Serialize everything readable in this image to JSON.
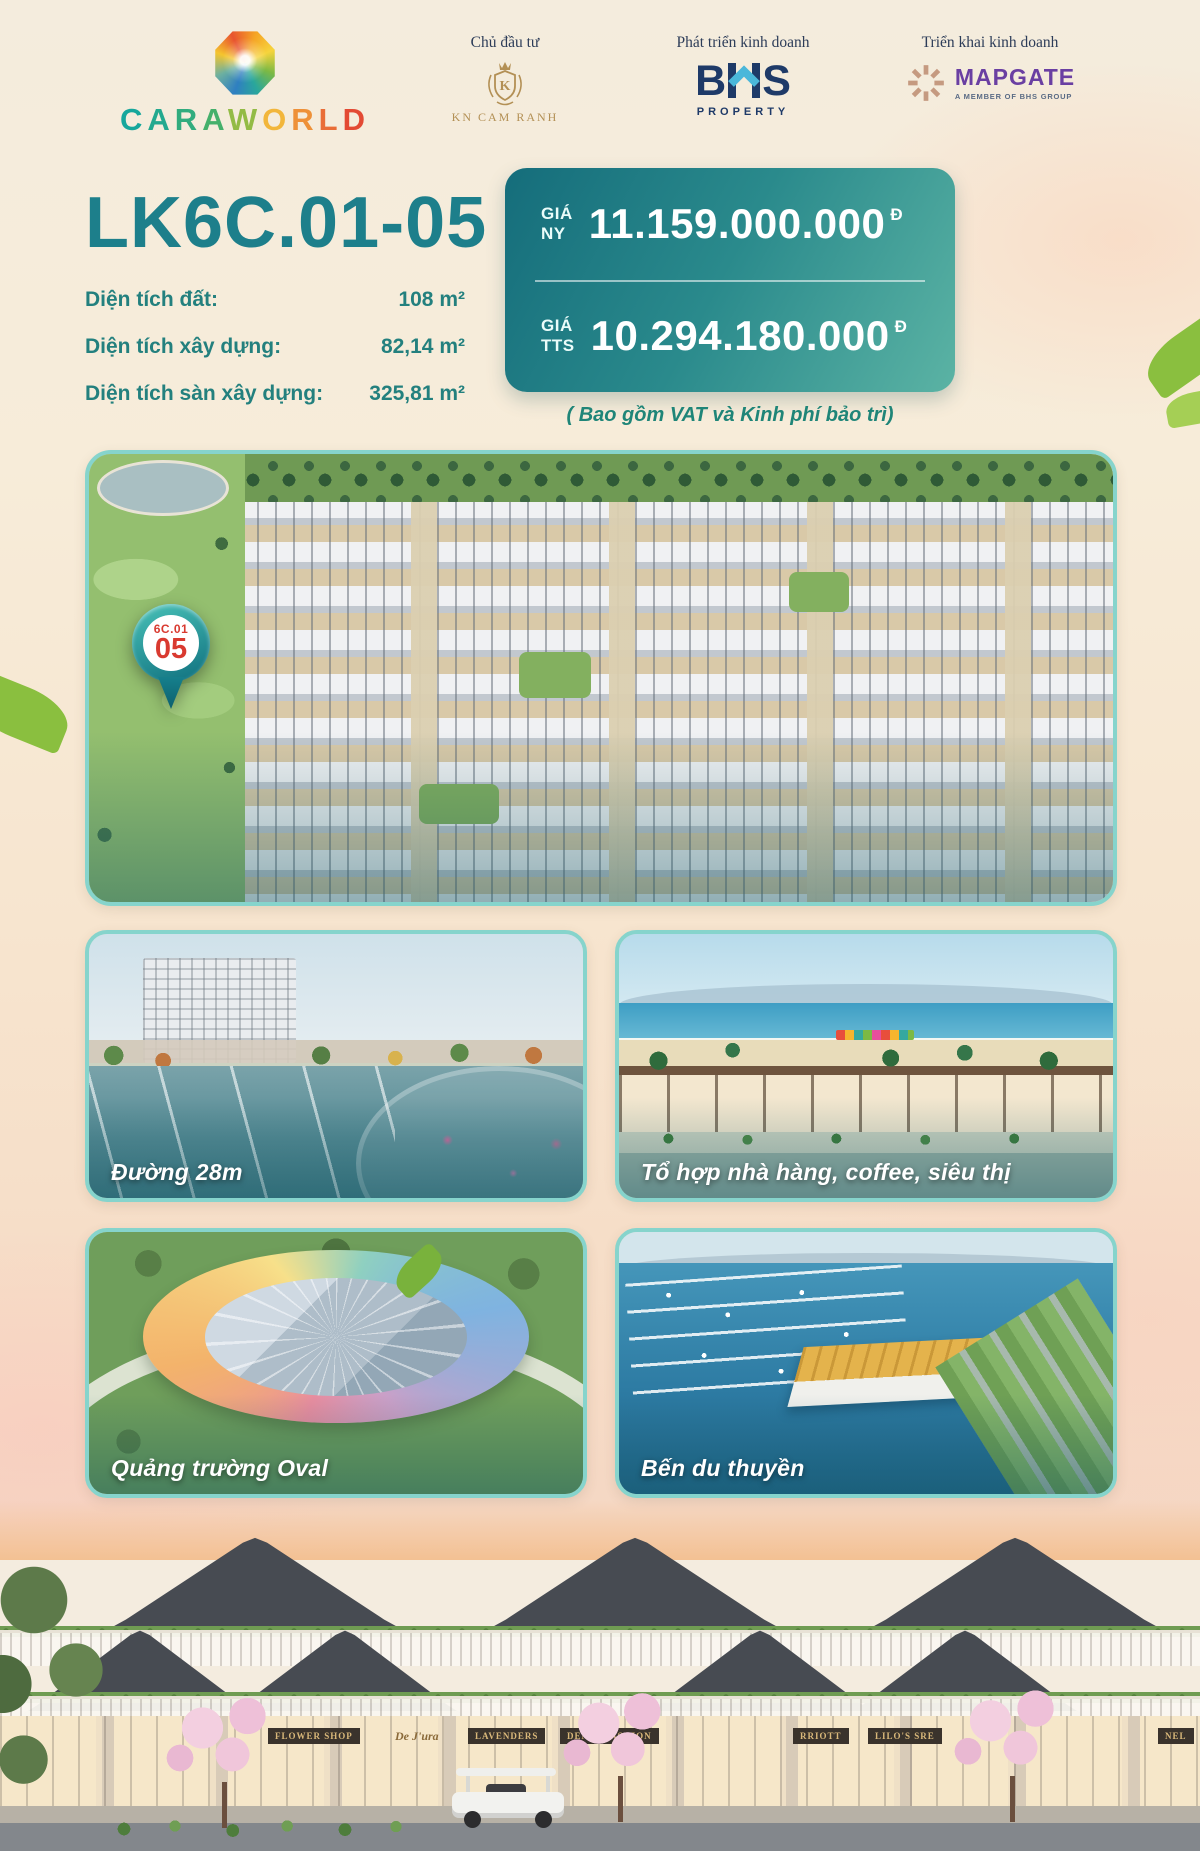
{
  "header": {
    "brand": {
      "name": "CARAWORLD",
      "letters": [
        "C",
        "A",
        "R",
        "A",
        "W",
        "O",
        "R",
        "L",
        "D"
      ]
    },
    "partners": [
      {
        "role": "Chủ đầu tư",
        "name": "KN CAM RANH",
        "monogram": "K"
      },
      {
        "role": "Phát triển kinh doanh",
        "name": "BHS",
        "letter_b": "B",
        "letter_s": "S",
        "sub": "PROPERTY"
      },
      {
        "role": "Triển khai kinh doanh",
        "name": "MAPGATE",
        "sub": "A MEMBER OF BHS GROUP"
      }
    ]
  },
  "listing": {
    "title": "LK6C.01-05",
    "details": [
      {
        "label": "Diện tích đất:",
        "value": "108 m²"
      },
      {
        "label": "Diện tích xây dựng:",
        "value": "82,14 m²"
      },
      {
        "label": "Diện tích sàn xây dựng:",
        "value": "325,81 m²"
      }
    ],
    "prices": [
      {
        "label_top": "GIÁ",
        "label_bottom": "NY",
        "value": "11.159.000.000",
        "currency": "Đ"
      },
      {
        "label_top": "GIÁ",
        "label_bottom": "TTS",
        "value": "10.294.180.000",
        "currency": "Đ"
      }
    ],
    "price_note": "( Bao gồm VAT và Kinh phí bảo trì)"
  },
  "map_pin": {
    "line1": "6C.01",
    "line2": "05"
  },
  "gallery": [
    {
      "caption": "Đường 28m"
    },
    {
      "caption": "Tổ hợp nhà hàng, coffee, siêu thị"
    },
    {
      "caption": "Quảng trường Oval"
    },
    {
      "caption": "Bến du thuyền"
    }
  ],
  "signs": [
    "FLOWER SHOP",
    "De J'ura",
    "LAVENDERS",
    "DENDI FASHION",
    "RRIOTT",
    "LILO'S SRE",
    "NEL"
  ],
  "colors": {
    "accent_teal": "#1d7f8b",
    "detail_teal": "#23807e",
    "price_box_gradient": [
      "#156d7b",
      "#5bb3a4"
    ],
    "price_note_teal": "#1f8578",
    "pin_red": "#d93a30",
    "photo_border": "#86d4cc",
    "bhs_navy": "#1e3a68",
    "bhs_chevron_blue": "#4ab7da",
    "mapgate_purple": "#6a3fa2",
    "mapgate_tan": "#c59a80",
    "kn_gold": "#b39055",
    "role_label_navy": "#2c3c58",
    "brand_letter_colors": [
      "#16a79c",
      "#23a98f",
      "#31ac7e",
      "#45b06b",
      "#93bb45",
      "#f2b63b",
      "#ee9139",
      "#e96d37",
      "#e34a34"
    ]
  }
}
